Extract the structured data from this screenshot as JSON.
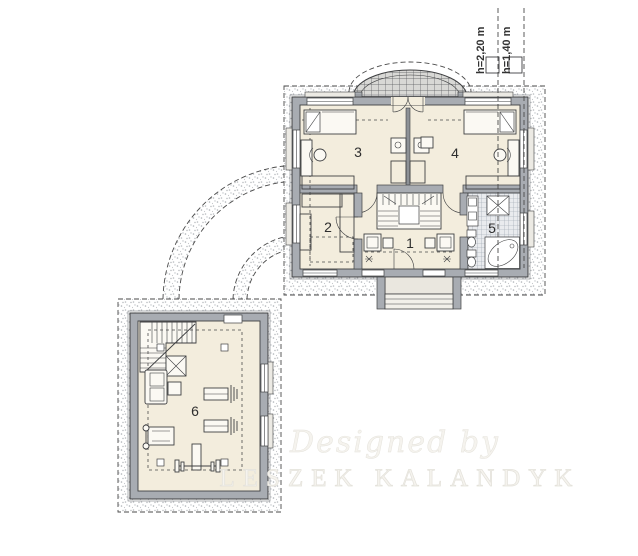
{
  "rooms": {
    "room1": "1",
    "room2": "2",
    "room3": "3",
    "room4": "4",
    "room5": "5",
    "room6": "6"
  },
  "annotations": {
    "height_upper": "h=2,20 m",
    "height_lower": "h=1,40 m"
  },
  "watermark": {
    "line1": "Designed by",
    "line2": "LESZEK KALANDYK"
  },
  "colors": {
    "wall": "#a8acb2",
    "floor": "#f3eddd",
    "outline": "#3f4042",
    "dash": "#4a4a4a",
    "stipple": "#aeb2b7",
    "tile": "#e9ebee",
    "tileline": "#98a1ab",
    "watermark_fill": "#f5f3ee",
    "watermark_stroke": "#e4e2db"
  }
}
